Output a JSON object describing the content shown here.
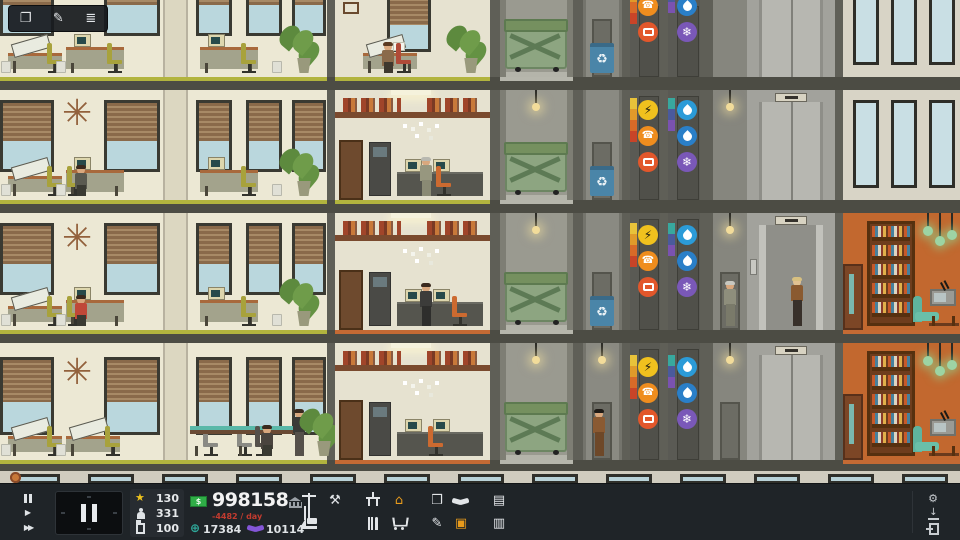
{
  "hud": {
    "float_tools": {
      "copy_glyph": "❐",
      "notes_glyph": "✎",
      "ledger_glyph": "≣"
    },
    "toolbar": {
      "glyphs": {
        "play": "▶",
        "ffwd": "▶▶",
        "star": "★",
        "tools": "⚒",
        "rooms": "⌂",
        "box": "❒",
        "leases": "▤",
        "paint": "✎",
        "decor": "▣",
        "media": "▥",
        "gear": "⚙",
        "save_arrow": "↓",
        "globe": "⊕",
        "money_symbol": "$"
      },
      "stats": {
        "prestige": "130",
        "population": "331",
        "floors": "100"
      },
      "money": {
        "balance": "998158",
        "daily_change": "-4482 / day",
        "influence": "17384",
        "favors": "10114"
      },
      "colors": {
        "star": "#eec31d",
        "bill_green": "#2fae47",
        "daily_red": "#c23b2f",
        "influence_teal": "#2fa89a",
        "favors_purple": "#8456d8",
        "highlight_orange": "#e89b1c"
      }
    }
  },
  "scene": {
    "glyphs": {
      "sunburst": "✳",
      "recycle": "♻"
    },
    "utility_icons": {
      "power": {
        "label": "power",
        "glyph": "⚡",
        "color": "#f0c11e"
      },
      "phone": {
        "label": "phone",
        "glyph": "☎",
        "color": "#ef8d1e"
      },
      "cable_tv": {
        "label": "cable-tv",
        "color": "#e2572b"
      },
      "water": {
        "label": "water",
        "color": "#2b9bd8"
      },
      "gas": {
        "label": "gas",
        "color": "#2a7fc8"
      },
      "hvac": {
        "label": "hvac",
        "glyph": "❄",
        "color": "#7a58b8"
      }
    }
  }
}
